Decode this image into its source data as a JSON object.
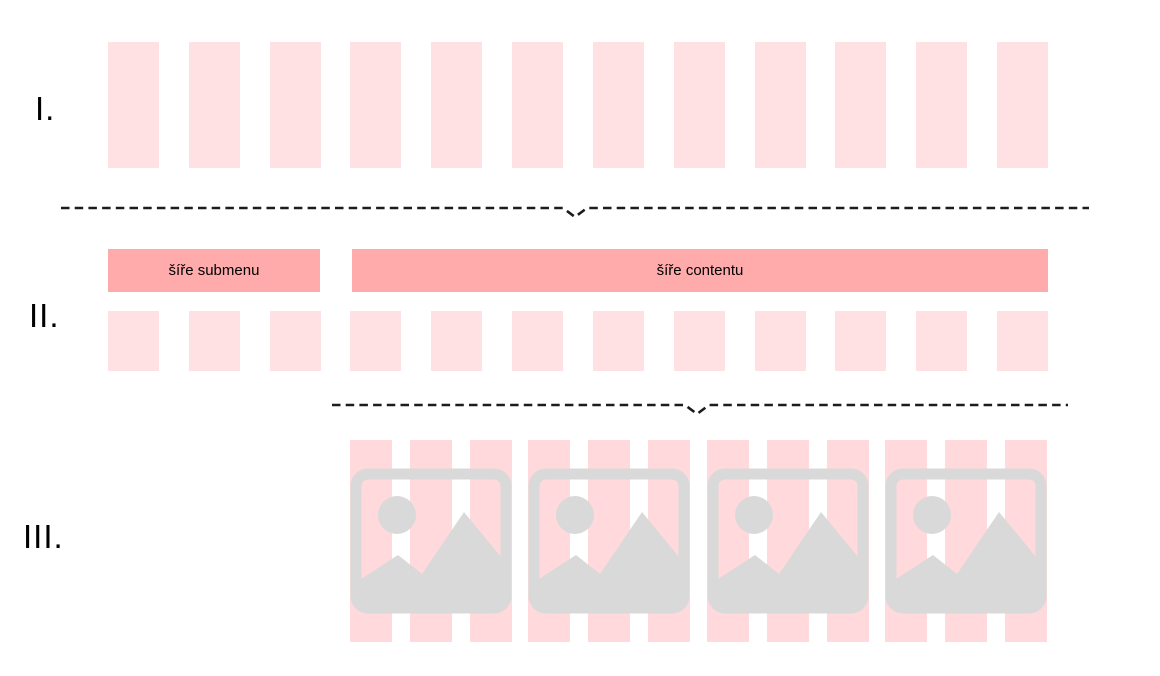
{
  "colors": {
    "background": "#ffffff",
    "column_light": "#ffe1e4",
    "stripe_pink": "#ffd9db",
    "bar_pink": "#ffabab",
    "icon_gray": "#d9d9d9",
    "dash_line": "#1c1c1c",
    "text": "#000000"
  },
  "sections": {
    "one": {
      "label": "I.",
      "column_count": 12
    },
    "two": {
      "label": "II.",
      "column_count": 12,
      "submenu_bar": "šíře submenu",
      "content_bar": "šíře contentu"
    },
    "three": {
      "label": "III.",
      "tile_count": 4,
      "stripes_per_tile": 3
    }
  }
}
